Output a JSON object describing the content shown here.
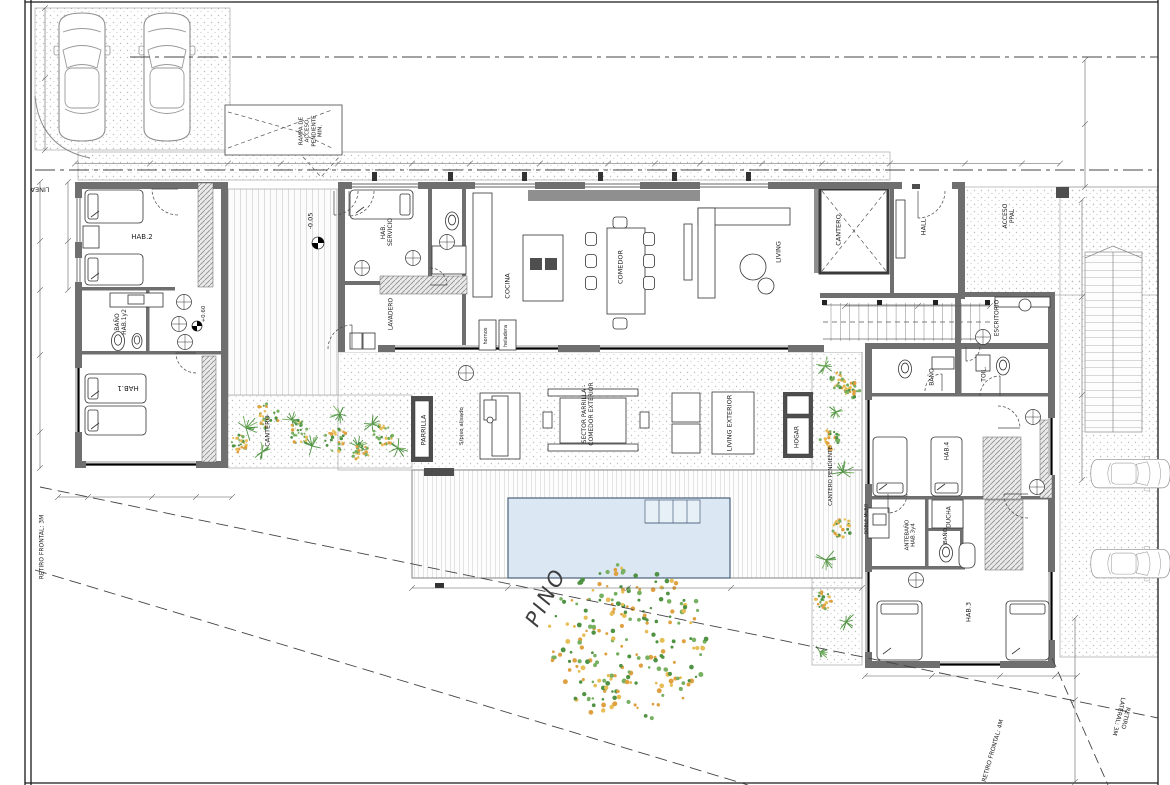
{
  "plan": {
    "type": "architectural-floor-plan",
    "labels": {
      "linea": "LINEA",
      "rampa": "RAMPA DE\nACCESO\nPENDIENTE\nMIN.",
      "hab2": "HAB.2",
      "bano_hab12": "BAÑO\nHAB.1y2",
      "hab1": "HAB.1",
      "cantero_izq": "CANTERO",
      "hab_servicio": "HAB.\nSERVICIO",
      "lavadero": "LAVADERO",
      "cocina": "COCINA",
      "hornos": "hornos",
      "heladera": "heladera",
      "comedor": "COMEDOR",
      "living": "LIVING",
      "cantero": "CANTERO",
      "hall": "HALL",
      "acceso_ppal": "ACCESO\nPPAL",
      "escritorio": "ESCRITORIO",
      "bano": "BAÑO",
      "toil": "TOIL.",
      "parrilla": "PARRILLA",
      "piso_alisado": "S/piso alisado",
      "sector_parrilla": "SECTOR PARRILLA -\nCOMEDOR EXTERIOR",
      "living_exterior": "LIVING EXTERIOR",
      "hogar": "HOGAR",
      "cantero_pendiente": "CANTERO PENDIENTE",
      "doble_muro": "DOBLE MURO",
      "hab4": "HAB.4",
      "ducha": "DUCHA",
      "antebano": "ANTEBAÑO\nHAB.3y4",
      "bano_chico": "BAÑO",
      "hab3": "HAB.3",
      "pino": "PINO",
      "retiro_frontal_izq": "RETIRO FRONTAL: 3M",
      "retiro_frontal_der": "RETIRO FRONTAL: 4M",
      "retiro_lateral": "RETIRO LATERAL: 3M",
      "nivel_acceso": "-0.05",
      "nivel_interior": "+0.60"
    },
    "colors": {
      "wall": "#6f6f6f",
      "line": "#2e2e2e",
      "pool_fill": "#dbe7f3",
      "pool_edge": "#49627c",
      "plant_green": "#4f9243",
      "plant_light_green": "#77b061",
      "plant_orange": "#dfa040",
      "plant_gold": "#e7bd55",
      "stipple": "#bdbdbd"
    }
  }
}
